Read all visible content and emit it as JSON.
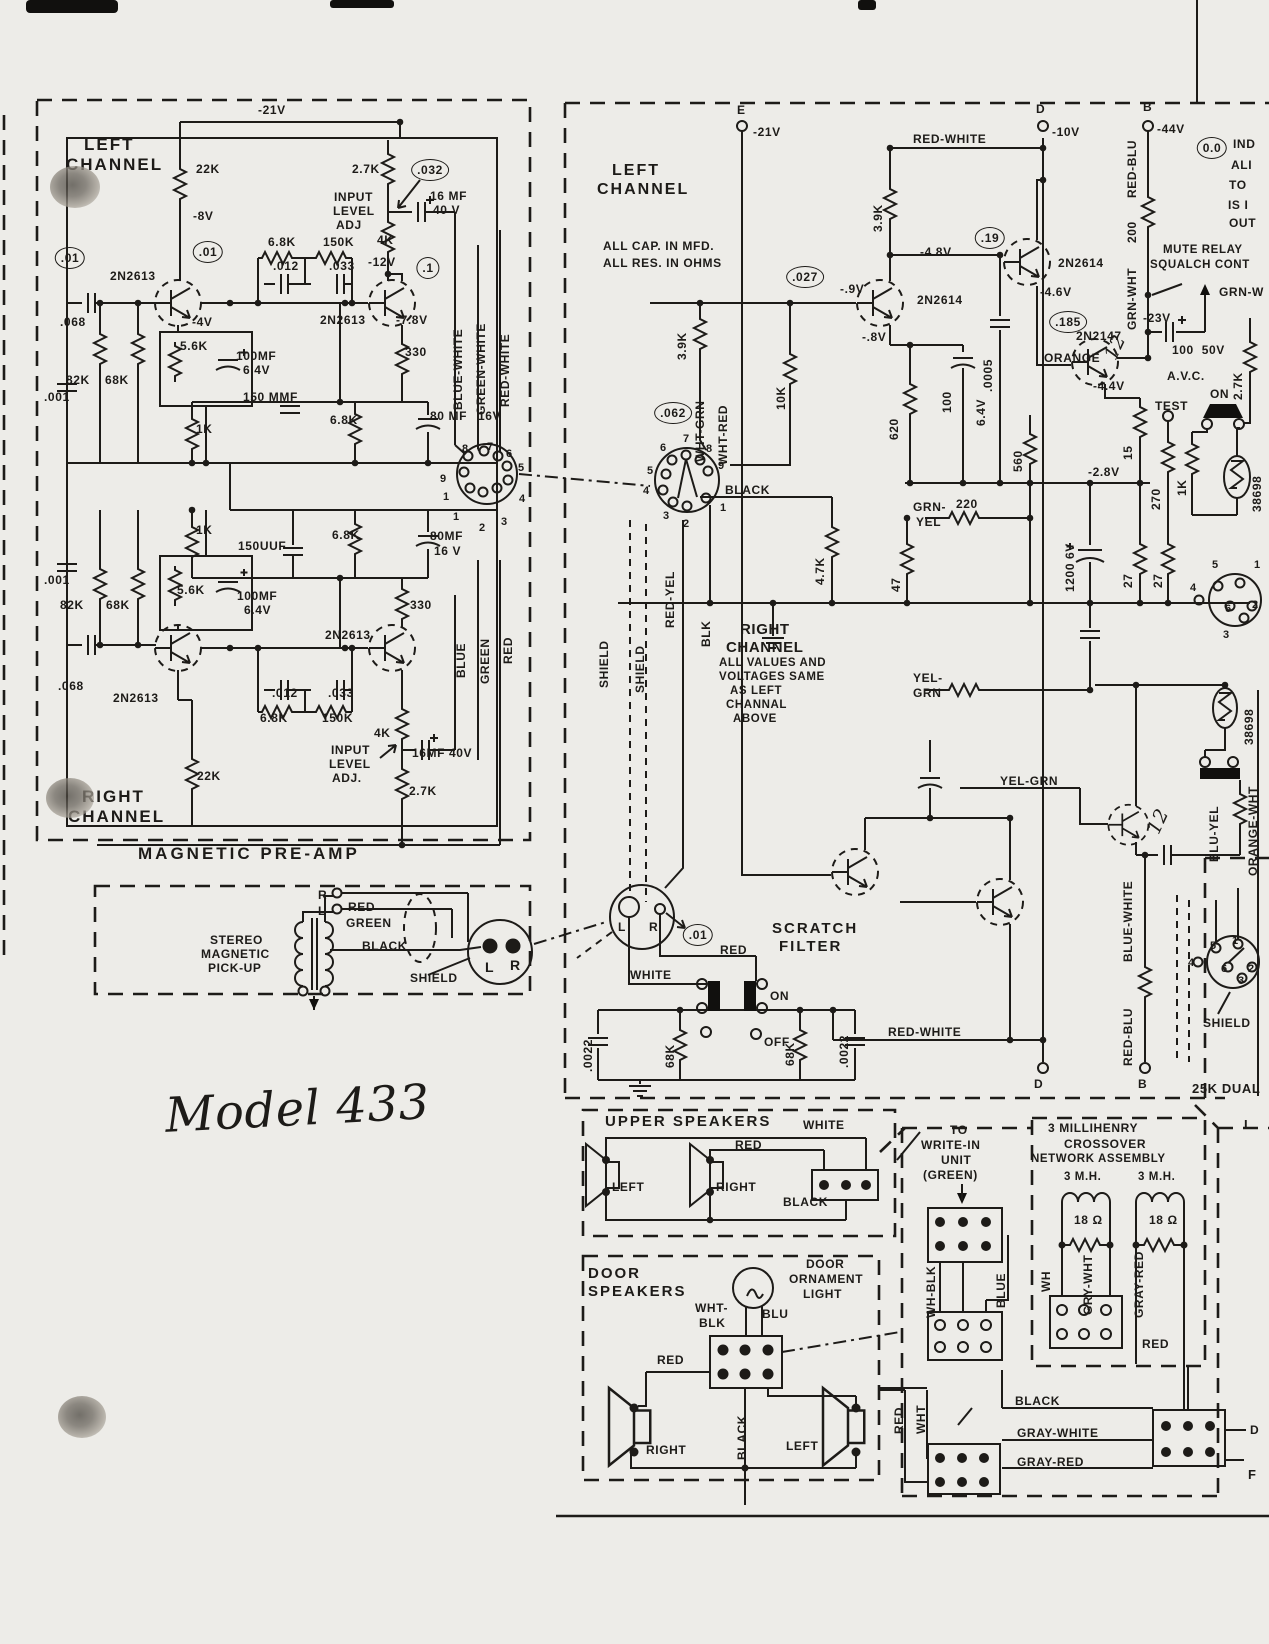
{
  "colors": {
    "ink": "#1d1b18",
    "paper": "#edece8"
  },
  "handwritten_note": "Model 433",
  "labels": [
    {
      "t": "-21V",
      "x": 258,
      "y": 104
    },
    {
      "t": "LEFT",
      "x": 84,
      "y": 136,
      "fs": 17,
      "ls": 2,
      "n": "preamp-left-channel-title"
    },
    {
      "t": "CHANNEL",
      "x": 66,
      "y": 156,
      "fs": 17,
      "ls": 2,
      "n": "preamp-left-channel-title"
    },
    {
      "t": "22K",
      "x": 196,
      "y": 163
    },
    {
      "t": "2.7K",
      "x": 352,
      "y": 163
    },
    {
      "t": ".032",
      "x": 430,
      "y": 170,
      "c": 1
    },
    {
      "t": "16 MF",
      "x": 430,
      "y": 190
    },
    {
      "t": "40 V",
      "x": 433,
      "y": 204
    },
    {
      "t": "INPUT",
      "x": 334,
      "y": 191
    },
    {
      "t": "LEVEL",
      "x": 333,
      "y": 205
    },
    {
      "t": "ADJ",
      "x": 336,
      "y": 219
    },
    {
      "t": "-8V",
      "x": 193,
      "y": 210
    },
    {
      "t": ".01",
      "x": 208,
      "y": 252,
      "c": 1
    },
    {
      "t": ".01",
      "x": 70,
      "y": 258,
      "c": 1
    },
    {
      "t": "6.8K",
      "x": 268,
      "y": 236
    },
    {
      "t": "150K",
      "x": 323,
      "y": 236
    },
    {
      "t": "4K",
      "x": 377,
      "y": 234
    },
    {
      "t": ".012",
      "x": 273,
      "y": 260
    },
    {
      "t": ".033",
      "x": 329,
      "y": 260
    },
    {
      "t": "-12V",
      "x": 368,
      "y": 256
    },
    {
      "t": ".1",
      "x": 428,
      "y": 268,
      "c": 1
    },
    {
      "t": "2N2613",
      "x": 110,
      "y": 270
    },
    {
      "t": ".068",
      "x": 60,
      "y": 316
    },
    {
      "t": "-4V",
      "x": 192,
      "y": 316
    },
    {
      "t": "2N2613",
      "x": 320,
      "y": 314
    },
    {
      "t": "-7.8V",
      "x": 396,
      "y": 314
    },
    {
      "t": "5.6K",
      "x": 180,
      "y": 340
    },
    {
      "t": "100MF",
      "x": 236,
      "y": 350
    },
    {
      "t": "6.4V",
      "x": 243,
      "y": 364
    },
    {
      "t": "330",
      "x": 405,
      "y": 346
    },
    {
      "t": "82K",
      "x": 66,
      "y": 374
    },
    {
      "t": "68K",
      "x": 105,
      "y": 374
    },
    {
      "t": ".001",
      "x": 44,
      "y": 391
    },
    {
      "t": "150 MMF",
      "x": 243,
      "y": 391
    },
    {
      "t": "1K",
      "x": 196,
      "y": 423
    },
    {
      "t": "6.8K",
      "x": 330,
      "y": 414
    },
    {
      "t": "80 MF",
      "x": 430,
      "y": 410
    },
    {
      "t": "16V",
      "x": 478,
      "y": 410
    },
    {
      "t": "8",
      "x": 462,
      "y": 444,
      "fs": 11
    },
    {
      "t": "7",
      "x": 487,
      "y": 442,
      "fs": 11
    },
    {
      "t": "6",
      "x": 506,
      "y": 449,
      "fs": 11
    },
    {
      "t": "5",
      "x": 518,
      "y": 463,
      "fs": 11
    },
    {
      "t": "9",
      "x": 440,
      "y": 474,
      "fs": 11
    },
    {
      "t": "1",
      "x": 443,
      "y": 492,
      "fs": 11
    },
    {
      "t": "4",
      "x": 519,
      "y": 494,
      "fs": 11
    },
    {
      "t": "1",
      "x": 453,
      "y": 512,
      "fs": 11
    },
    {
      "t": "2",
      "x": 479,
      "y": 523,
      "fs": 11
    },
    {
      "t": "3",
      "x": 501,
      "y": 517,
      "fs": 11
    },
    {
      "t": "1K",
      "x": 196,
      "y": 524
    },
    {
      "t": "150UUF",
      "x": 238,
      "y": 540
    },
    {
      "t": "6.8K",
      "x": 332,
      "y": 529
    },
    {
      "t": "80MF",
      "x": 430,
      "y": 530
    },
    {
      "t": "16 V",
      "x": 434,
      "y": 545
    },
    {
      "t": ".001",
      "x": 44,
      "y": 574
    },
    {
      "t": "5.6K",
      "x": 177,
      "y": 584
    },
    {
      "t": "100MF",
      "x": 237,
      "y": 590
    },
    {
      "t": "6.4V",
      "x": 244,
      "y": 604
    },
    {
      "t": "82K",
      "x": 60,
      "y": 599
    },
    {
      "t": "68K",
      "x": 106,
      "y": 599
    },
    {
      "t": "330",
      "x": 410,
      "y": 599
    },
    {
      "t": "2N2613",
      "x": 325,
      "y": 629
    },
    {
      "t": ".068",
      "x": 58,
      "y": 680
    },
    {
      "t": "2N2613",
      "x": 113,
      "y": 692
    },
    {
      "t": ".012",
      "x": 272,
      "y": 687
    },
    {
      "t": ".033",
      "x": 328,
      "y": 687
    },
    {
      "t": "6.8K",
      "x": 260,
      "y": 712
    },
    {
      "t": "150K",
      "x": 322,
      "y": 712
    },
    {
      "t": "4K",
      "x": 374,
      "y": 727
    },
    {
      "t": "INPUT",
      "x": 331,
      "y": 744
    },
    {
      "t": "LEVEL",
      "x": 329,
      "y": 758
    },
    {
      "t": "ADJ.",
      "x": 332,
      "y": 772
    },
    {
      "t": "16MF 40V",
      "x": 412,
      "y": 747
    },
    {
      "t": "2.7K",
      "x": 409,
      "y": 785
    },
    {
      "t": "22K",
      "x": 197,
      "y": 770
    },
    {
      "t": "RIGHT",
      "x": 82,
      "y": 788,
      "fs": 17,
      "ls": 2,
      "n": "preamp-right-channel-title"
    },
    {
      "t": "CHANNEL",
      "x": 68,
      "y": 808,
      "fs": 17,
      "ls": 2,
      "n": "preamp-right-channel-title"
    },
    {
      "t": "MAGNETIC PRE-AMP",
      "x": 138,
      "y": 845,
      "fs": 17,
      "ls": 3,
      "n": "preamp-title"
    },
    {
      "t": "BLUE-WHITE",
      "v": 1,
      "x": 452,
      "y": 410
    },
    {
      "t": "GREEN-WHITE",
      "v": 1,
      "x": 475,
      "y": 415
    },
    {
      "t": "RED-WHITE",
      "v": 1,
      "x": 499,
      "y": 407
    },
    {
      "t": "BLUE",
      "v": 1,
      "x": 455,
      "y": 678
    },
    {
      "t": "GREEN",
      "v": 1,
      "x": 479,
      "y": 684
    },
    {
      "t": "RED",
      "v": 1,
      "x": 502,
      "y": 664
    },
    {
      "t": "R",
      "x": 318,
      "y": 889
    },
    {
      "t": "L",
      "x": 318,
      "y": 905
    },
    {
      "t": "RED",
      "x": 348,
      "y": 901
    },
    {
      "t": "GREEN",
      "x": 346,
      "y": 917
    },
    {
      "t": "STEREO",
      "x": 210,
      "y": 934,
      "n": "pickup-title"
    },
    {
      "t": "MAGNETIC",
      "x": 201,
      "y": 948,
      "n": "pickup-title"
    },
    {
      "t": "PICK-UP",
      "x": 208,
      "y": 962,
      "n": "pickup-title"
    },
    {
      "t": "BLACK",
      "x": 362,
      "y": 940
    },
    {
      "t": "SHIELD",
      "x": 410,
      "y": 972
    },
    {
      "t": "L",
      "x": 485,
      "y": 960,
      "fs": 14
    },
    {
      "t": "R",
      "x": 510,
      "y": 958,
      "fs": 14
    },
    {
      "t": "Model 433",
      "x": 165,
      "y": 1085,
      "hand": 1,
      "fs": 48,
      "rot": -3,
      "n": "model-number"
    },
    {
      "t": "E",
      "x": 737,
      "y": 104
    },
    {
      "t": "-21V",
      "x": 753,
      "y": 126
    },
    {
      "t": "LEFT",
      "x": 612,
      "y": 163,
      "fs": 16,
      "ls": 2,
      "n": "left-channel-title"
    },
    {
      "t": "CHANNEL",
      "x": 597,
      "y": 182,
      "fs": 16,
      "ls": 2,
      "n": "left-channel-title"
    },
    {
      "t": "ALL CAP. IN MFD.",
      "x": 603,
      "y": 240,
      "n": "notes"
    },
    {
      "t": "ALL RES. IN OHMS",
      "x": 603,
      "y": 257,
      "n": "notes"
    },
    {
      "t": "RED-WHITE",
      "x": 913,
      "y": 133
    },
    {
      "t": ".19",
      "x": 990,
      "y": 238,
      "c": 1
    },
    {
      "t": "-4.8V",
      "x": 920,
      "y": 246
    },
    {
      "t": ".027",
      "x": 805,
      "y": 277,
      "c": 1
    },
    {
      "t": "-.9V",
      "x": 840,
      "y": 283
    },
    {
      "t": "2N2614",
      "x": 917,
      "y": 294
    },
    {
      "t": "-.8V",
      "x": 862,
      "y": 331
    },
    {
      "t": ".062",
      "x": 673,
      "y": 413,
      "c": 1
    },
    {
      "t": "BLACK",
      "x": 725,
      "y": 484
    },
    {
      "t": "GRN-",
      "x": 913,
      "y": 501
    },
    {
      "t": "YEL",
      "x": 916,
      "y": 516
    },
    {
      "t": "220",
      "x": 956,
      "y": 498
    },
    {
      "t": "RIGHT",
      "x": 740,
      "y": 622,
      "fs": 15
    },
    {
      "t": "CHANNEL",
      "x": 726,
      "y": 640,
      "fs": 15
    },
    {
      "t": "ALL VALUES AND",
      "x": 719,
      "y": 658,
      "fs": 11.5
    },
    {
      "t": "VOLTAGES SAME",
      "x": 719,
      "y": 672,
      "fs": 11.5
    },
    {
      "t": "AS LEFT",
      "x": 730,
      "y": 686,
      "fs": 11.5
    },
    {
      "t": "CHANNAL",
      "x": 726,
      "y": 700,
      "fs": 11.5
    },
    {
      "t": "ABOVE",
      "x": 733,
      "y": 714,
      "fs": 11.5
    },
    {
      "t": "YEL-",
      "x": 913,
      "y": 672
    },
    {
      "t": "GRN",
      "x": 913,
      "y": 687
    },
    {
      "t": "YEL-GRN",
      "x": 1000,
      "y": 775
    },
    {
      "t": "-2.8V",
      "x": 1088,
      "y": 466
    },
    {
      "t": "-4.4V",
      "x": 1093,
      "y": 380
    },
    {
      "t": "TEST",
      "x": 1155,
      "y": 400
    },
    {
      "t": "ON",
      "x": 1210,
      "y": 388
    },
    {
      "t": "-4.6V",
      "x": 1040,
      "y": 286
    },
    {
      "t": ".185",
      "x": 1068,
      "y": 322,
      "c": 1
    },
    {
      "t": "2N2147",
      "x": 1076,
      "y": 330
    },
    {
      "t": "-23V",
      "x": 1143,
      "y": 312
    },
    {
      "t": "ORANGE",
      "x": 1044,
      "y": 352
    },
    {
      "t": "100  50V",
      "x": 1172,
      "y": 344
    },
    {
      "t": "A.V.C.",
      "x": 1167,
      "y": 370
    },
    {
      "t": "2N2614",
      "x": 1058,
      "y": 257
    },
    {
      "t": "D",
      "x": 1036,
      "y": 103
    },
    {
      "t": "-10V",
      "x": 1052,
      "y": 126
    },
    {
      "t": "B",
      "x": 1143,
      "y": 101
    },
    {
      "t": "-44V",
      "x": 1157,
      "y": 123
    },
    {
      "t": "0.0",
      "x": 1212,
      "y": 148,
      "c": 1
    },
    {
      "t": "IND",
      "x": 1233,
      "y": 138,
      "n": "notes"
    },
    {
      "t": "ALI",
      "x": 1231,
      "y": 159,
      "n": "notes"
    },
    {
      "t": "TO",
      "x": 1229,
      "y": 179,
      "n": "notes"
    },
    {
      "t": "IS I",
      "x": 1228,
      "y": 199,
      "n": "notes"
    },
    {
      "t": "OUT",
      "x": 1229,
      "y": 217,
      "n": "notes"
    },
    {
      "t": "MUTE RELAY",
      "x": 1163,
      "y": 245,
      "fs": 11.5
    },
    {
      "t": "SQUALCH CONT",
      "x": 1150,
      "y": 260,
      "fs": 11.5
    },
    {
      "t": "GRN-W",
      "x": 1219,
      "y": 286
    },
    {
      "t": "6",
      "x": 660,
      "y": 443,
      "fs": 11
    },
    {
      "t": "7",
      "x": 683,
      "y": 434,
      "fs": 11
    },
    {
      "t": "8",
      "x": 706,
      "y": 444,
      "fs": 11
    },
    {
      "t": "9",
      "x": 718,
      "y": 461,
      "fs": 11
    },
    {
      "t": "5",
      "x": 647,
      "y": 466,
      "fs": 11
    },
    {
      "t": "4",
      "x": 643,
      "y": 486,
      "fs": 11
    },
    {
      "t": "3",
      "x": 663,
      "y": 511,
      "fs": 11
    },
    {
      "t": "2",
      "x": 683,
      "y": 519,
      "fs": 11
    },
    {
      "t": "1",
      "x": 720,
      "y": 503,
      "fs": 11
    },
    {
      "t": "SCRATCH",
      "x": 772,
      "y": 921,
      "fs": 15,
      "ls": 2,
      "n": "scratch-filter-title"
    },
    {
      "t": "FILTER",
      "x": 779,
      "y": 939,
      "fs": 15,
      "ls": 2,
      "n": "scratch-filter-title"
    },
    {
      "t": "L",
      "x": 618,
      "y": 921
    },
    {
      "t": "R",
      "x": 649,
      "y": 921
    },
    {
      "t": ".01",
      "x": 698,
      "y": 935,
      "c": 1
    },
    {
      "t": "RED",
      "x": 720,
      "y": 944
    },
    {
      "t": "WHITE",
      "x": 630,
      "y": 969
    },
    {
      "t": "ON",
      "x": 770,
      "y": 990
    },
    {
      "t": "OFF",
      "x": 764,
      "y": 1036
    },
    {
      "t": "RED-WHITE",
      "x": 888,
      "y": 1026
    },
    {
      "t": "D",
      "x": 1034,
      "y": 1078
    },
    {
      "t": "B",
      "x": 1138,
      "y": 1078
    },
    {
      "t": "25K DUAL",
      "x": 1192,
      "y": 1082,
      "fs": 13
    },
    {
      "t": "SHIELD",
      "x": 1203,
      "y": 1017
    },
    {
      "t": "5",
      "x": 1210,
      "y": 941,
      "fs": 11
    },
    {
      "t": "1",
      "x": 1232,
      "y": 936,
      "fs": 11
    },
    {
      "t": "4",
      "x": 1188,
      "y": 958,
      "fs": 11
    },
    {
      "t": "6",
      "x": 1221,
      "y": 964,
      "fs": 11
    },
    {
      "t": "2",
      "x": 1248,
      "y": 964,
      "fs": 11
    },
    {
      "t": "3",
      "x": 1238,
      "y": 976,
      "fs": 11
    },
    {
      "t": "5",
      "x": 1212,
      "y": 560,
      "fs": 11
    },
    {
      "t": "1",
      "x": 1254,
      "y": 560,
      "fs": 11
    },
    {
      "t": "4",
      "x": 1190,
      "y": 583,
      "fs": 11
    },
    {
      "t": "6",
      "x": 1225,
      "y": 604,
      "fs": 11
    },
    {
      "t": "2",
      "x": 1252,
      "y": 600,
      "fs": 11
    },
    {
      "t": "3",
      "x": 1223,
      "y": 630,
      "fs": 11
    },
    {
      "t": "3.9K",
      "v": 1,
      "x": 676,
      "y": 360
    },
    {
      "t": "WHT-GRN",
      "v": 1,
      "x": 694,
      "y": 462
    },
    {
      "t": "WHT-RED",
      "v": 1,
      "x": 717,
      "y": 465
    },
    {
      "t": "10K",
      "v": 1,
      "x": 775,
      "y": 410
    },
    {
      "t": "3.9K",
      "v": 1,
      "x": 872,
      "y": 232
    },
    {
      "t": ".0005",
      "v": 1,
      "x": 982,
      "y": 392
    },
    {
      "t": "620",
      "v": 1,
      "x": 888,
      "y": 440
    },
    {
      "t": "100",
      "v": 1,
      "x": 941,
      "y": 413
    },
    {
      "t": "6.4V",
      "v": 1,
      "x": 975,
      "y": 426
    },
    {
      "t": "RED-YEL",
      "v": 1,
      "x": 664,
      "y": 628
    },
    {
      "t": "BLK",
      "v": 1,
      "x": 700,
      "y": 647
    },
    {
      "t": "SHIELD",
      "v": 1,
      "x": 598,
      "y": 688
    },
    {
      "t": "SHIELD",
      "v": 1,
      "x": 634,
      "y": 693
    },
    {
      "t": "4.7K",
      "v": 1,
      "x": 814,
      "y": 585
    },
    {
      "t": "47",
      "v": 1,
      "x": 890,
      "y": 592
    },
    {
      "t": "560",
      "v": 1,
      "x": 1012,
      "y": 472
    },
    {
      "t": "15",
      "v": 1,
      "x": 1122,
      "y": 460
    },
    {
      "t": "270",
      "v": 1,
      "x": 1150,
      "y": 510
    },
    {
      "t": "1K",
      "v": 1,
      "x": 1176,
      "y": 496
    },
    {
      "t": "2.7K",
      "v": 1,
      "x": 1232,
      "y": 400
    },
    {
      "t": "38698",
      "v": 1,
      "x": 1251,
      "y": 512
    },
    {
      "t": "1200 6V",
      "v": 1,
      "x": 1064,
      "y": 592
    },
    {
      "t": "27",
      "v": 1,
      "x": 1122,
      "y": 588
    },
    {
      "t": "27",
      "v": 1,
      "x": 1152,
      "y": 588
    },
    {
      "t": "GRN-WHT",
      "v": 1,
      "x": 1126,
      "y": 330
    },
    {
      "t": "200",
      "v": 1,
      "x": 1126,
      "y": 243
    },
    {
      "t": "RED-BLU",
      "v": 1,
      "x": 1126,
      "y": 198
    },
    {
      "t": "BLU-YEL",
      "v": 1,
      "x": 1208,
      "y": 862
    },
    {
      "t": "ORANGE-WHT",
      "v": 1,
      "x": 1247,
      "y": 876
    },
    {
      "t": "38698",
      "v": 1,
      "x": 1243,
      "y": 745
    },
    {
      "t": "BLUE-WHITE",
      "v": 1,
      "x": 1122,
      "y": 962
    },
    {
      "t": "RED-BLU",
      "v": 1,
      "x": 1122,
      "y": 1066
    },
    {
      "t": ".0022",
      "v": 1,
      "x": 582,
      "y": 1072
    },
    {
      "t": "68K",
      "v": 1,
      "x": 664,
      "y": 1068
    },
    {
      "t": "68K",
      "v": 1,
      "x": 784,
      "y": 1066
    },
    {
      "t": ".0022",
      "v": 1,
      "x": 838,
      "y": 1068
    },
    {
      "t": "12",
      "hand": 1,
      "rot": -65,
      "x": 1103,
      "y": 338,
      "fs": 19
    },
    {
      "t": "12",
      "hand": 1,
      "rot": -65,
      "x": 1146,
      "y": 812,
      "fs": 19
    },
    {
      "t": "UPPER SPEAKERS",
      "x": 605,
      "y": 1114,
      "fs": 15,
      "ls": 2,
      "n": "upper-speakers-title"
    },
    {
      "t": "WHITE",
      "x": 803,
      "y": 1119
    },
    {
      "t": "RED",
      "x": 735,
      "y": 1139
    },
    {
      "t": "LEFT",
      "x": 612,
      "y": 1181
    },
    {
      "t": "RIGHT",
      "x": 716,
      "y": 1181
    },
    {
      "t": "BLACK",
      "x": 783,
      "y": 1196
    },
    {
      "t": "TO",
      "x": 950,
      "y": 1124
    },
    {
      "t": "WRITE-IN",
      "x": 921,
      "y": 1139
    },
    {
      "t": "UNIT",
      "x": 941,
      "y": 1154
    },
    {
      "t": "(GREEN)",
      "x": 923,
      "y": 1169
    },
    {
      "t": "DOOR",
      "x": 588,
      "y": 1266,
      "fs": 15,
      "ls": 2,
      "n": "door-speakers-title"
    },
    {
      "t": "SPEAKERS",
      "x": 588,
      "y": 1284,
      "fs": 15,
      "ls": 2,
      "n": "door-speakers-title"
    },
    {
      "t": "DOOR",
      "x": 806,
      "y": 1258
    },
    {
      "t": "ORNAMENT",
      "x": 789,
      "y": 1273
    },
    {
      "t": "LIGHT",
      "x": 803,
      "y": 1288
    },
    {
      "t": "WHT-",
      "x": 695,
      "y": 1302
    },
    {
      "t": "BLK",
      "x": 699,
      "y": 1317
    },
    {
      "t": "BLU",
      "x": 762,
      "y": 1308
    },
    {
      "t": "RED",
      "x": 657,
      "y": 1354
    },
    {
      "t": "RIGHT",
      "x": 646,
      "y": 1444
    },
    {
      "t": "LEFT",
      "x": 786,
      "y": 1440
    },
    {
      "t": "BLACK",
      "x": 1015,
      "y": 1395
    },
    {
      "t": "GRAY-WHITE",
      "x": 1017,
      "y": 1427
    },
    {
      "t": "GRAY-RED",
      "x": 1017,
      "y": 1456
    },
    {
      "t": "3 MILLIHENRY",
      "x": 1048,
      "y": 1122,
      "n": "crossover-title"
    },
    {
      "t": "CROSSOVER",
      "x": 1064,
      "y": 1138,
      "n": "crossover-title"
    },
    {
      "t": "NETWORK ASSEMBLY",
      "x": 1031,
      "y": 1154,
      "fs": 11.5,
      "n": "crossover-title"
    },
    {
      "t": "3 M.H.",
      "x": 1064,
      "y": 1172,
      "fs": 11.5
    },
    {
      "t": "3 M.H.",
      "x": 1138,
      "y": 1172,
      "fs": 11.5
    },
    {
      "t": "18 Ω",
      "x": 1074,
      "y": 1214
    },
    {
      "t": "18 Ω",
      "x": 1149,
      "y": 1214
    },
    {
      "t": "RED",
      "x": 1142,
      "y": 1338
    },
    {
      "t": "L",
      "x": 1244,
      "y": 1118,
      "fs": 13
    },
    {
      "t": "D",
      "x": 1250,
      "y": 1424
    },
    {
      "t": "F",
      "x": 1248,
      "y": 1468,
      "fs": 13
    },
    {
      "t": "WH-BLK",
      "v": 1,
      "x": 925,
      "y": 1318
    },
    {
      "t": "BLUE",
      "v": 1,
      "x": 995,
      "y": 1308
    },
    {
      "t": "RED",
      "v": 1,
      "x": 893,
      "y": 1434
    },
    {
      "t": "WHT",
      "v": 1,
      "x": 915,
      "y": 1434
    },
    {
      "t": "BLACK",
      "v": 1,
      "x": 736,
      "y": 1460
    },
    {
      "t": "WH",
      "v": 1,
      "x": 1040,
      "y": 1292
    },
    {
      "t": "GRY-WHT",
      "v": 1,
      "x": 1082,
      "y": 1315
    },
    {
      "t": "GRAY-RED",
      "v": 1,
      "x": 1133,
      "y": 1318
    }
  ]
}
